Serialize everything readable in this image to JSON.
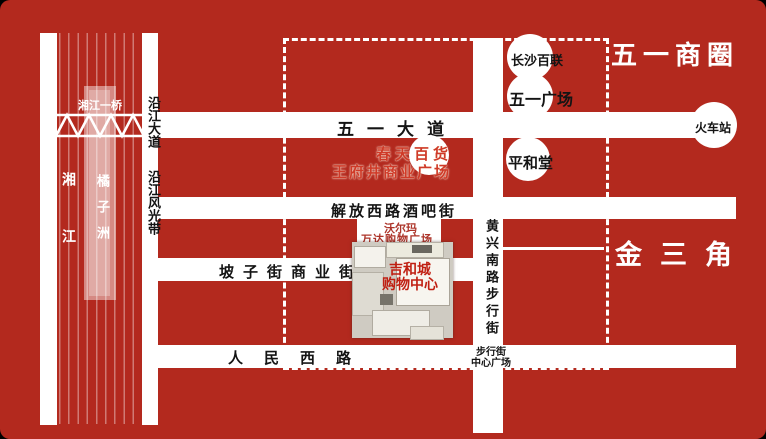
{
  "canvas": {
    "background_color": "#b3291e",
    "road_color": "#ffffff",
    "highlight_red": "#c01f12"
  },
  "areas": {
    "business_circle": "五一商圈",
    "golden_triangle": "金三角"
  },
  "river": {
    "name": "湘江",
    "island": "橘子洲",
    "bridge": "湘江一桥"
  },
  "roads": {
    "riverside_avenue": "沿江大道",
    "riverside_scenic_belt": "沿江风光带",
    "wuyi_avenue": "五一大道",
    "jiefang_west_bar_street": "解放西路酒吧街",
    "pozi_commercial_street": "坡子街商业街",
    "renmin_west_road": "人民西路",
    "huangxing_south_pedestrian": "黄兴南路步行街"
  },
  "landmarks": {
    "changsha_bailian": "长沙百联",
    "wuyi_square": "五一广场",
    "pinghetang": "平和堂",
    "train_station": "火车站",
    "spring_department_store": "春天百货",
    "wangfujing_plaza": "王府井商业广场",
    "walmart": "沃尔玛",
    "wanda_plaza": "万达购物广场",
    "mall_name": "吉和城",
    "mall_type": "购物中心",
    "pedestrian_street": "步行街",
    "center_square": "中心广场"
  }
}
